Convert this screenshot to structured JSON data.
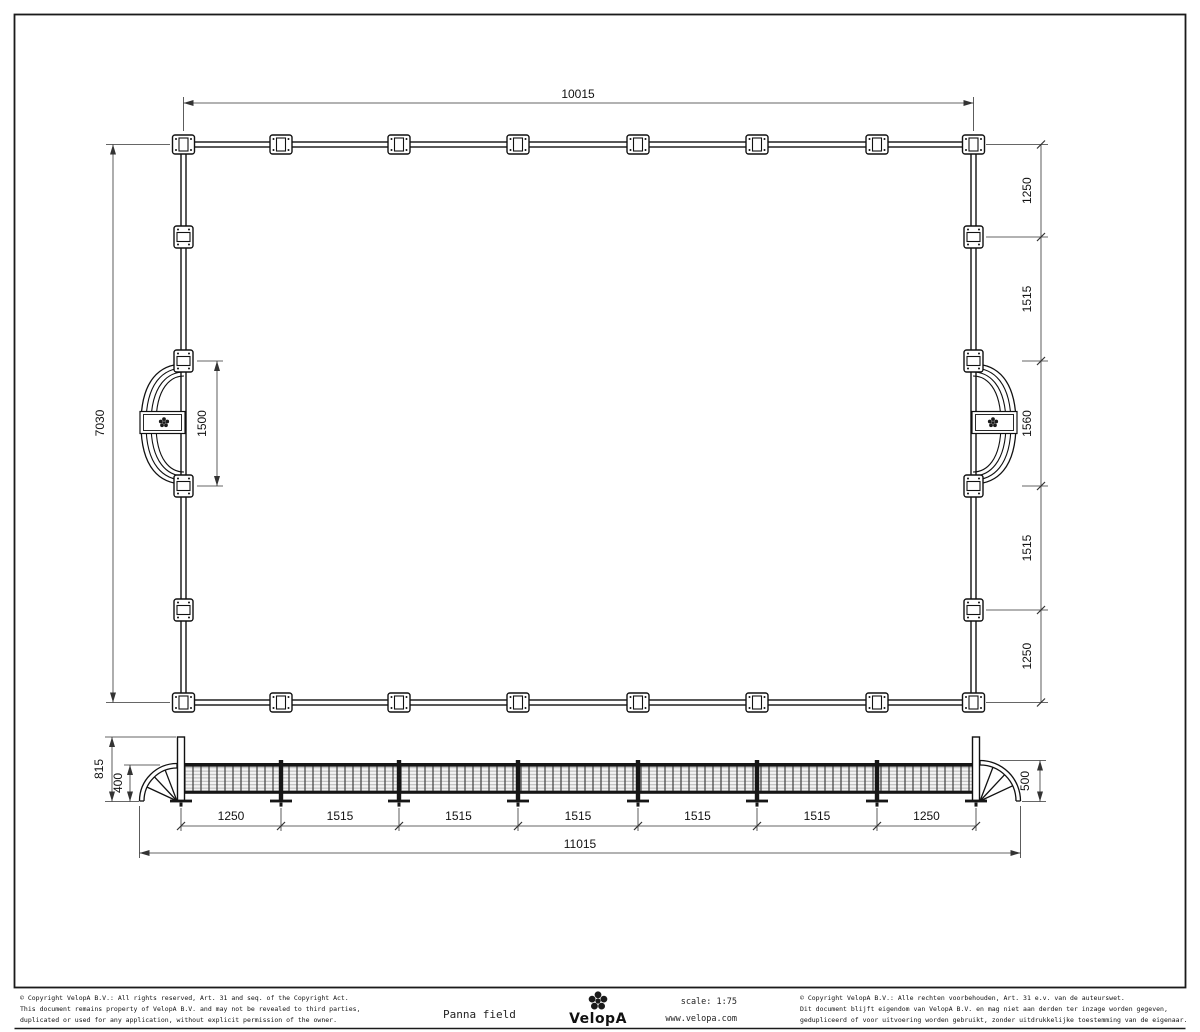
{
  "plan": {
    "width": "10015",
    "height": "7030",
    "goal_opening": "1500",
    "right_chain": [
      "1250",
      "1515",
      "1560",
      "1515",
      "1250"
    ]
  },
  "elevation": {
    "post_height": "815",
    "left_goal_height": "400",
    "right_goal_height": "500",
    "bottom_chain": [
      "1250",
      "1515",
      "1515",
      "1515",
      "1515",
      "1515",
      "1250"
    ],
    "total_width": "11015"
  },
  "title_block": {
    "drawing_title": "Panna field",
    "brand": "VelopA",
    "scale": "scale:  1:75",
    "website": "www.velopa.com",
    "copyright_en": [
      "© Copyright VelopA B.V.: All rights reserved, Art. 31 and seq. of the Copyright Act.",
      "This document remains property of VelopA B.V. and may not be revealed to third parties,",
      "duplicated or used for any application, without explicit permission of the owner."
    ],
    "copyright_nl": [
      "© Copyright VelopA B.V.: Alle rechten voorbehouden, Art. 31 e.v. van de auteurswet.",
      "Dit document blijft eigendom van VelopA B.V. en mag niet aan derden ter inzage worden gegeven,",
      "gedupliceerd of voor uitvoering worden gebruikt, zonder uitdrukkelijke toestemming van de eigenaar."
    ]
  }
}
